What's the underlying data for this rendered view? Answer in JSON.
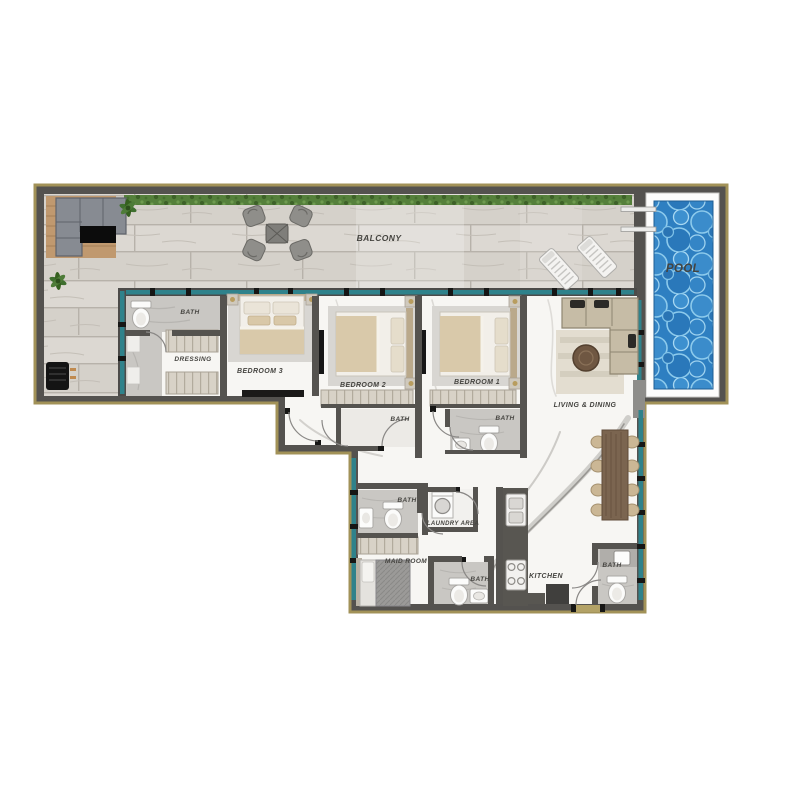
{
  "plan": {
    "type": "apartment-floor-plan",
    "colors": {
      "wall": "#54524f",
      "outline": "#a29258",
      "glazing": "#2f828b",
      "pool_water": "#2e7fc1",
      "wood_floor": "#d6d2cb",
      "marble_floor": "#f7f6f3",
      "tile_floor": "#c9c7c3",
      "hedge": "#55803b",
      "label_text": "#454440"
    }
  },
  "rooms": [
    {
      "id": "balcony",
      "label": "BALCONY"
    },
    {
      "id": "pool",
      "label": "POOL"
    },
    {
      "id": "bath-bed3",
      "label": "BATH"
    },
    {
      "id": "dressing",
      "label": "DRESSING"
    },
    {
      "id": "bedroom-3",
      "label": "BEDROOM 3"
    },
    {
      "id": "bedroom-2",
      "label": "BEDROOM 2"
    },
    {
      "id": "bedroom-1",
      "label": "BEDROOM 1"
    },
    {
      "id": "bath-bed2",
      "label": "BATH"
    },
    {
      "id": "bath-bed1",
      "label": "BATH"
    },
    {
      "id": "living-dining",
      "label": "LIVING & DINING"
    },
    {
      "id": "bath-maid",
      "label": "BATH"
    },
    {
      "id": "laundry-area",
      "label": "LAUNDRY AREA"
    },
    {
      "id": "maid-room",
      "label": "MAID ROOM"
    },
    {
      "id": "bath-guest",
      "label": "BATH"
    },
    {
      "id": "kitchen",
      "label": "KITCHEN"
    },
    {
      "id": "bath-powder",
      "label": "BATH"
    }
  ]
}
